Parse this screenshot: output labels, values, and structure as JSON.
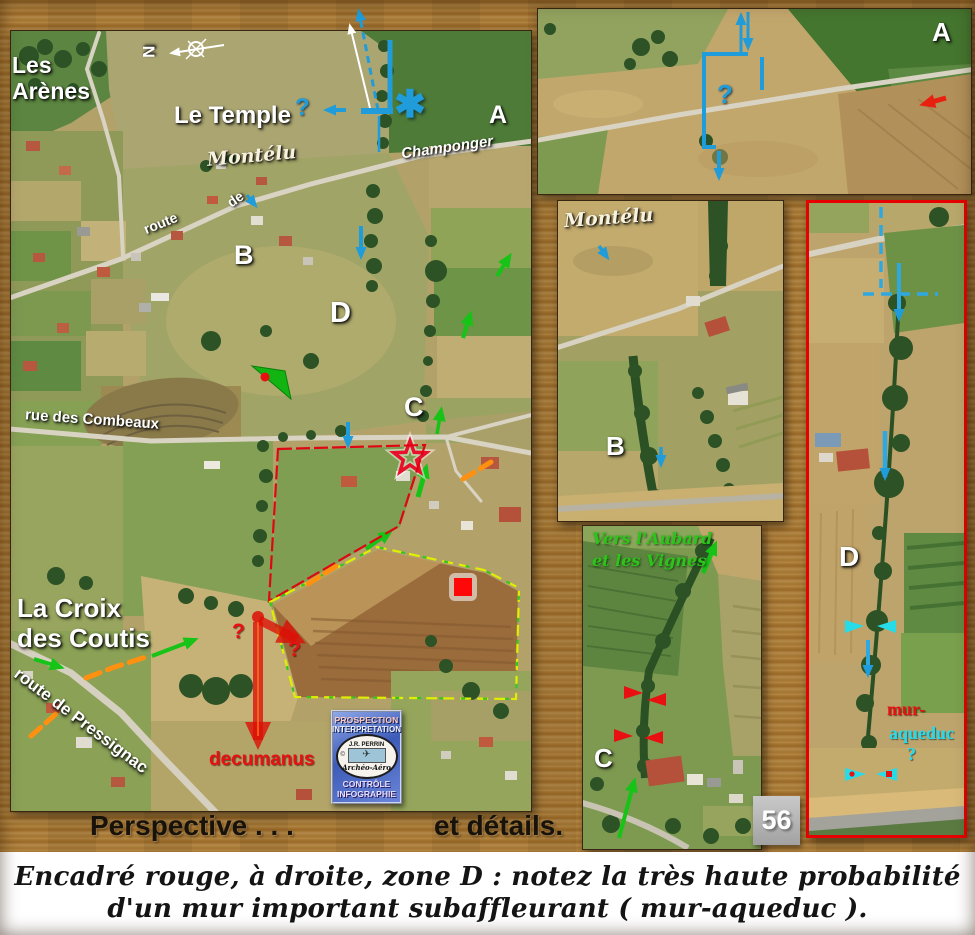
{
  "colors": {
    "annotation_blue": "#1f9cd9",
    "annotation_cyan": "#25dcee",
    "annotation_green": "#1ec81e",
    "annotation_red": "#e81010",
    "annotation_orange": "#ff9010",
    "annotation_yellow": "#e0ee00",
    "panel_d_frame_red": "#e60000",
    "wood_brown": "#ad7c35",
    "caption_background": "#ffffff"
  },
  "main_photo": {
    "place_les_arenes": "Les\nArènes",
    "compass_north": "N",
    "place_le_temple": "Le Temple",
    "place_montelu": "Montélu",
    "question_blue": "?",
    "asterisk": "✱",
    "road_champonger": "Champonger",
    "zone_a": "A",
    "road_route": "route",
    "road_de": "de",
    "zone_b": "B",
    "zone_d": "D",
    "zone_c": "C",
    "road_rue_des_combeaux": "rue  des  Combeaux",
    "place_la_croix_des_coutis": "La Croix\ndes Coutis",
    "road_route_de_pressignac": "route  de  Pressignac",
    "question_red_1": "?",
    "question_red_2": "?",
    "label_decumanus": "decumanus"
  },
  "logo": {
    "line1": "PROSPECTION",
    "line2": "INTERPRETATION",
    "oval_top": "J.R. PERRIN",
    "copyright": "©",
    "plane_icon": "✈",
    "oval_bottom": "Archéo-Aéro",
    "line3": "CONTRÔLE",
    "line4": "INFOGRAPHIE"
  },
  "panel_a": {
    "zone_label": "A",
    "question": "?"
  },
  "panel_b": {
    "place_montelu": "Montélu",
    "zone_label": "B"
  },
  "panel_c": {
    "direction_note": "Vers l'Aubard\net les Vignes",
    "zone_label": "C"
  },
  "panel_d": {
    "zone_label": "D",
    "label_mur": "mur-",
    "label_aqueduc": "aqueduc",
    "question": "?"
  },
  "footer": {
    "perspective": "Perspective . . .",
    "details": "et détails.",
    "page_number": "56"
  },
  "caption": {
    "line1": "Encadré rouge, à droite, zone D : notez la très haute probabilité",
    "line2": "d'un mur important subaffleurant ( mur-aqueduc )."
  }
}
